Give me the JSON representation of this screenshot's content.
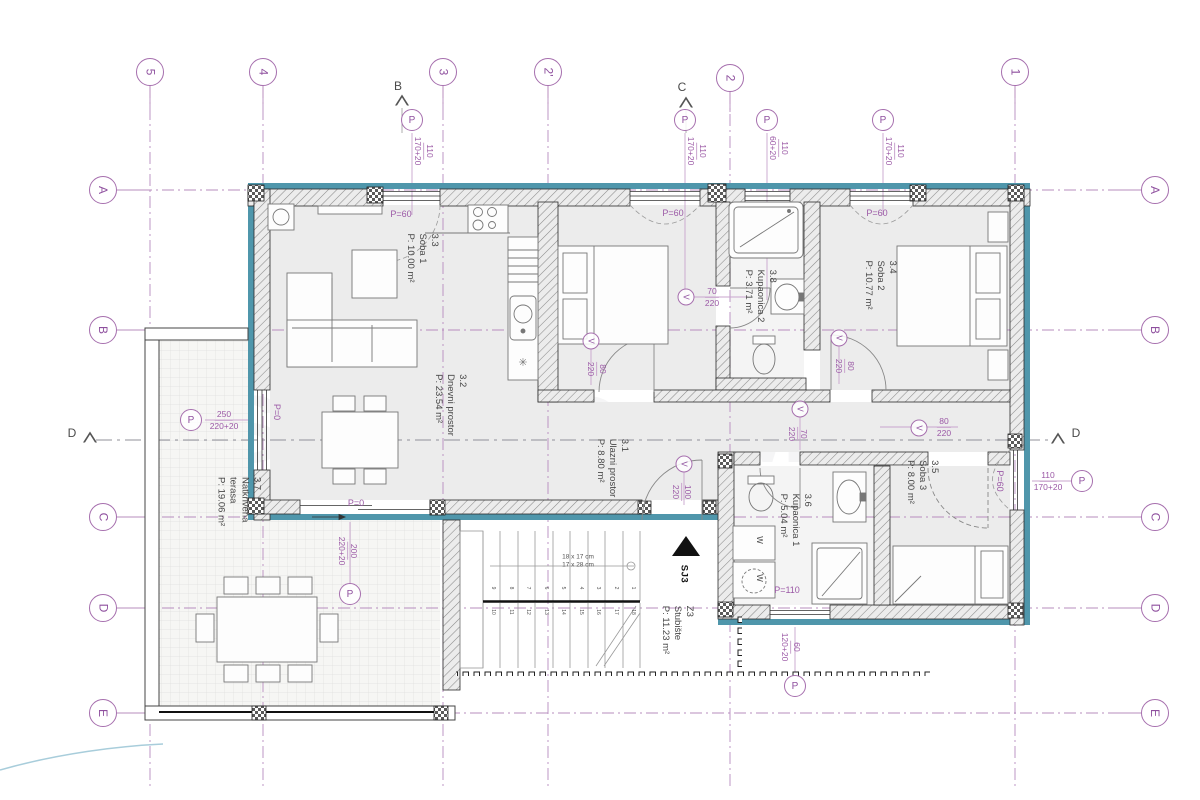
{
  "colors": {
    "exterior_face": "#4f96ab",
    "annotation_purple": "#9b59a6"
  },
  "watermark": {
    "line1": "SIMIĆDOM",
    "line2": "AV"
  },
  "grid": {
    "cols": [
      "5",
      "4",
      "3",
      "2'",
      "2",
      "1"
    ],
    "rows": [
      "A",
      "B",
      "C",
      "D",
      "E"
    ],
    "section_label_left": "D",
    "section_label_right": "D"
  },
  "facade_markers": {
    "b": "B",
    "c": "C"
  },
  "rooms": {
    "dnevni": {
      "num": "3.2",
      "name": "Dnevni prostor",
      "area": "P: 23.54 m²"
    },
    "ulazni": {
      "num": "3.1",
      "name": "Ulazni prostor",
      "area": "P: 8.80 m²"
    },
    "soba1": {
      "num": "3.3",
      "name": "Soba 1",
      "area": "P: 10.00 m²"
    },
    "kupaonica2": {
      "num": "3.8",
      "name": "Kupaonica 2",
      "area": "P: 3.71 m²"
    },
    "soba2": {
      "num": "3.4",
      "name": "Soba 2",
      "area": "P: 10.77 m²"
    },
    "soba3": {
      "num": "3.5",
      "name": "Soba 3",
      "area": "P: 8.00 m²"
    },
    "kupaonica1": {
      "num": "3.6",
      "name": "Kupaonica 1",
      "area": "P: 5.04 m²"
    },
    "terasa": {
      "num": "3.7",
      "name": "Natkrivena terasa",
      "area": "P: 19.06 m²"
    },
    "stubiste": {
      "num": "Z3",
      "name": "Stubište",
      "area": "P: 11.23 m²"
    }
  },
  "windows": {
    "symbol": "P",
    "top_living": {
      "w": "110",
      "h": "170+20"
    },
    "top_soba1": {
      "w": "110",
      "h": "170+20"
    },
    "top_kupaonica2": {
      "w": "110",
      "h": "60+20"
    },
    "top_soba2": {
      "w": "110",
      "h": "170+20"
    },
    "left_living": {
      "w": "250",
      "h": "220+20"
    },
    "terrace_door": {
      "w": "200",
      "h": "220+20"
    },
    "right_soba3": {
      "w": "110",
      "h": "170+20"
    },
    "bottom_kupaonica1": {
      "w": "60",
      "h": "120+20"
    }
  },
  "doors": {
    "symbol": "V",
    "soba1": {
      "w": "80",
      "h": "220"
    },
    "kupaonica2": {
      "w": "70",
      "h": "220"
    },
    "soba2": {
      "w": "80",
      "h": "220"
    },
    "soba3": {
      "w": "80",
      "h": "220"
    },
    "kupaonica1": {
      "w": "70",
      "h": "220"
    },
    "entrance": {
      "w": "100",
      "h": "220"
    }
  },
  "parapets": {
    "kitchen": "P=60",
    "soba1": "P=60",
    "soba2": "P=60",
    "soba3": "P=60",
    "living_side": "P=0",
    "terrace_door": "P=0",
    "kupaonica1": "P=110"
  },
  "stairs": {
    "note_rise": "18 x 17 cm",
    "note_run": "17 x 28 cm",
    "entry": "SJ3",
    "treads": [
      "1",
      "2",
      "3",
      "4",
      "5",
      "6",
      "7",
      "8",
      "9",
      "10",
      "11",
      "12",
      "13",
      "14",
      "15",
      "16",
      "17",
      "18"
    ]
  },
  "appliances": {
    "washer1": "W",
    "washer2": "W"
  }
}
